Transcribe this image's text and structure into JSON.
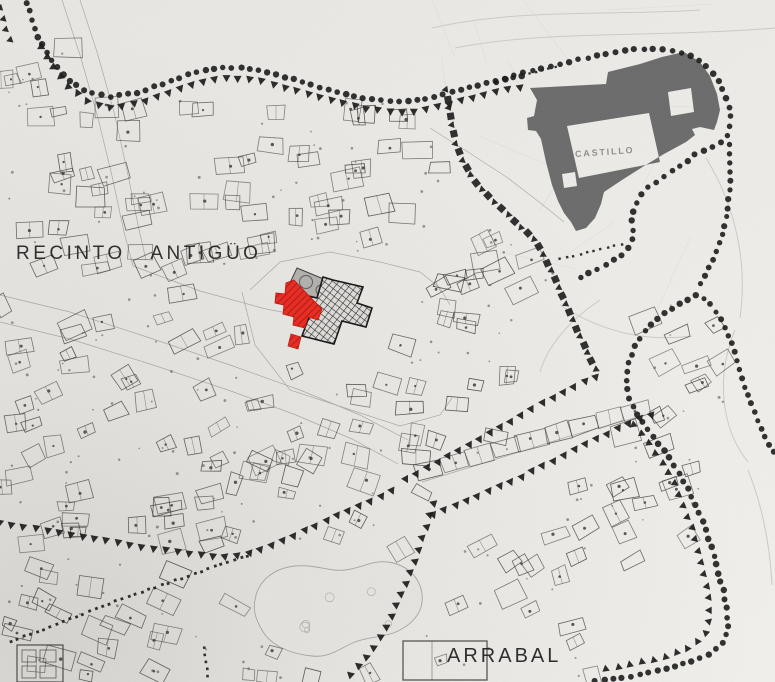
{
  "page": {
    "kind": "scanned historical city plan"
  },
  "labels": {
    "recinto": "RECINTO ANTIGÜO",
    "castillo": "CASTILLO",
    "arrabal": "ARRABAL"
  },
  "colors": {
    "paper": "#e7e6e2",
    "paper_light": "#f1f0ec",
    "paper_shade": "#56534c",
    "building_line": "#3b3a38",
    "marker": "#171717",
    "castle_fill": "#6a6a6a",
    "red_fill": "#e8291f",
    "red_hatch": "#9c100c",
    "red_outline": "#c2170f",
    "gray_parcel": "#b2b0ad",
    "crosshatch_bg": "#dcdbd7",
    "crosshatch_line": "#1e1e1e",
    "park_fill": "#e4e3df",
    "park_stroke": "#a3a19c",
    "street": "#56534f",
    "contour": "#c9c7c2"
  },
  "boundary_styles": {
    "wall_dots": "circle",
    "wall_triangles": "triangle",
    "minor_dots": "square"
  },
  "features": [
    {
      "id": "castle",
      "kind": "fortress-silhouette",
      "label_ref": "castillo"
    },
    {
      "id": "red-building",
      "kind": "red-highlighted-building"
    },
    {
      "id": "crosshatch-building",
      "kind": "crosshatched-monument-block"
    },
    {
      "id": "gray-parcel",
      "kind": "gray-shaded-parcel"
    },
    {
      "id": "old-town-wall",
      "kind": "dotted-wall-boundary"
    },
    {
      "id": "arrabal-wall",
      "kind": "dotted-wall-boundary"
    }
  ]
}
